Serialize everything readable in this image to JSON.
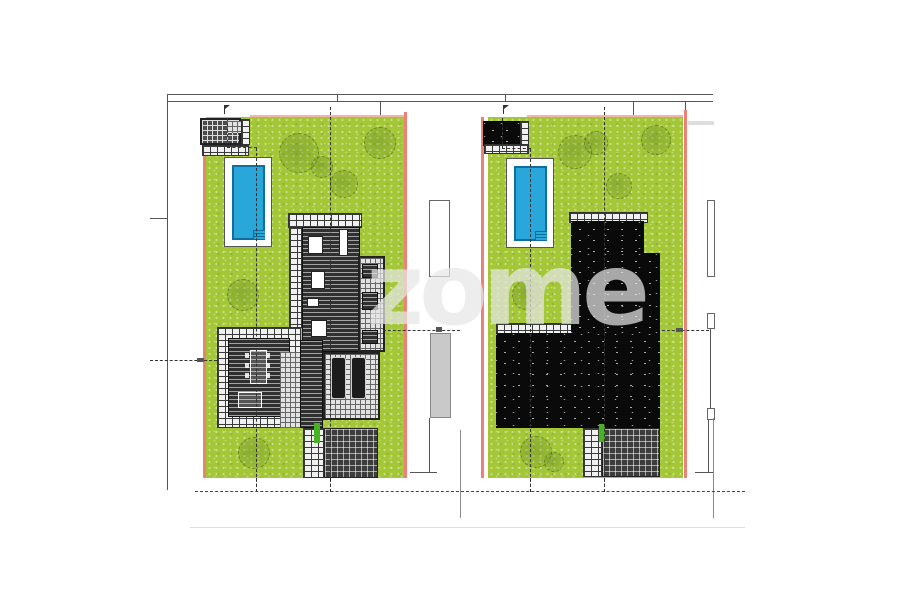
{
  "watermark": {
    "text": "zome"
  },
  "colors": {
    "grass": "#a3c737",
    "pool-water": "#29a7db",
    "pool-edge": "#0e6f9e",
    "boundary-red": "#ee8177",
    "boundary-pink": "#f6b3ac",
    "roof-black": "#0a0a0a",
    "deck-dark": "#303030",
    "paving-light": "#f0f0f0",
    "grid-dark": "#3d3d3d",
    "neighbor-gray": "#c9c9c9",
    "marker-green": "#46b31f",
    "line": "#555555"
  }
}
